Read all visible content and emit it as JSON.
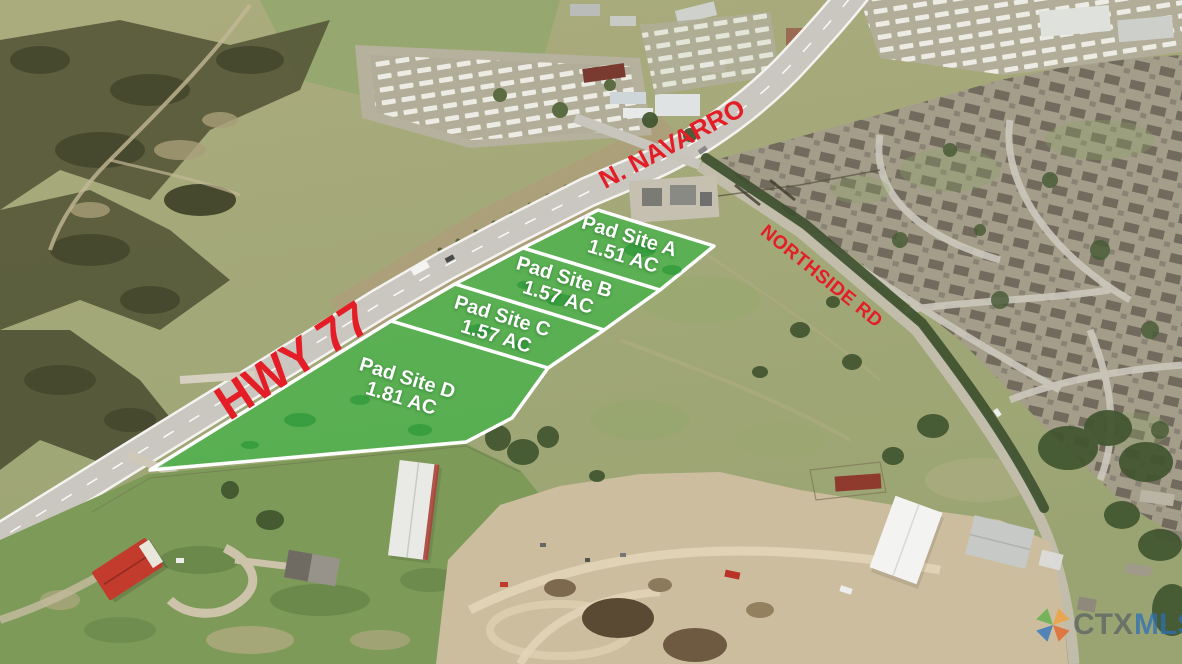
{
  "road_labels": {
    "hwy77": "HWY 77",
    "navarro": "N. NAVARRO",
    "northside": "NORTHSIDE RD"
  },
  "pad_sites": [
    {
      "name": "Pad Site A",
      "acreage": "1.51 AC"
    },
    {
      "name": "Pad Site B",
      "acreage": "1.57 AC"
    },
    {
      "name": "Pad Site C",
      "acreage": "1.57 AC"
    },
    {
      "name": "Pad Site D",
      "acreage": "1.81 AC"
    }
  ],
  "watermark": {
    "prefix": "CTX",
    "suffix": "MLS"
  },
  "colors": {
    "road_label_red": "#e41e26",
    "pad_site_green": "#2db53c",
    "pad_site_border": "#ffffff",
    "pad_site_text": "#ffffff",
    "watermark_prefix_color": "#585e63",
    "watermark_suffix_color": "#2b70b8",
    "watermark_logo_colors": [
      "#5fb14a",
      "#f0a03c",
      "#2f74bd",
      "#e2662b"
    ]
  }
}
